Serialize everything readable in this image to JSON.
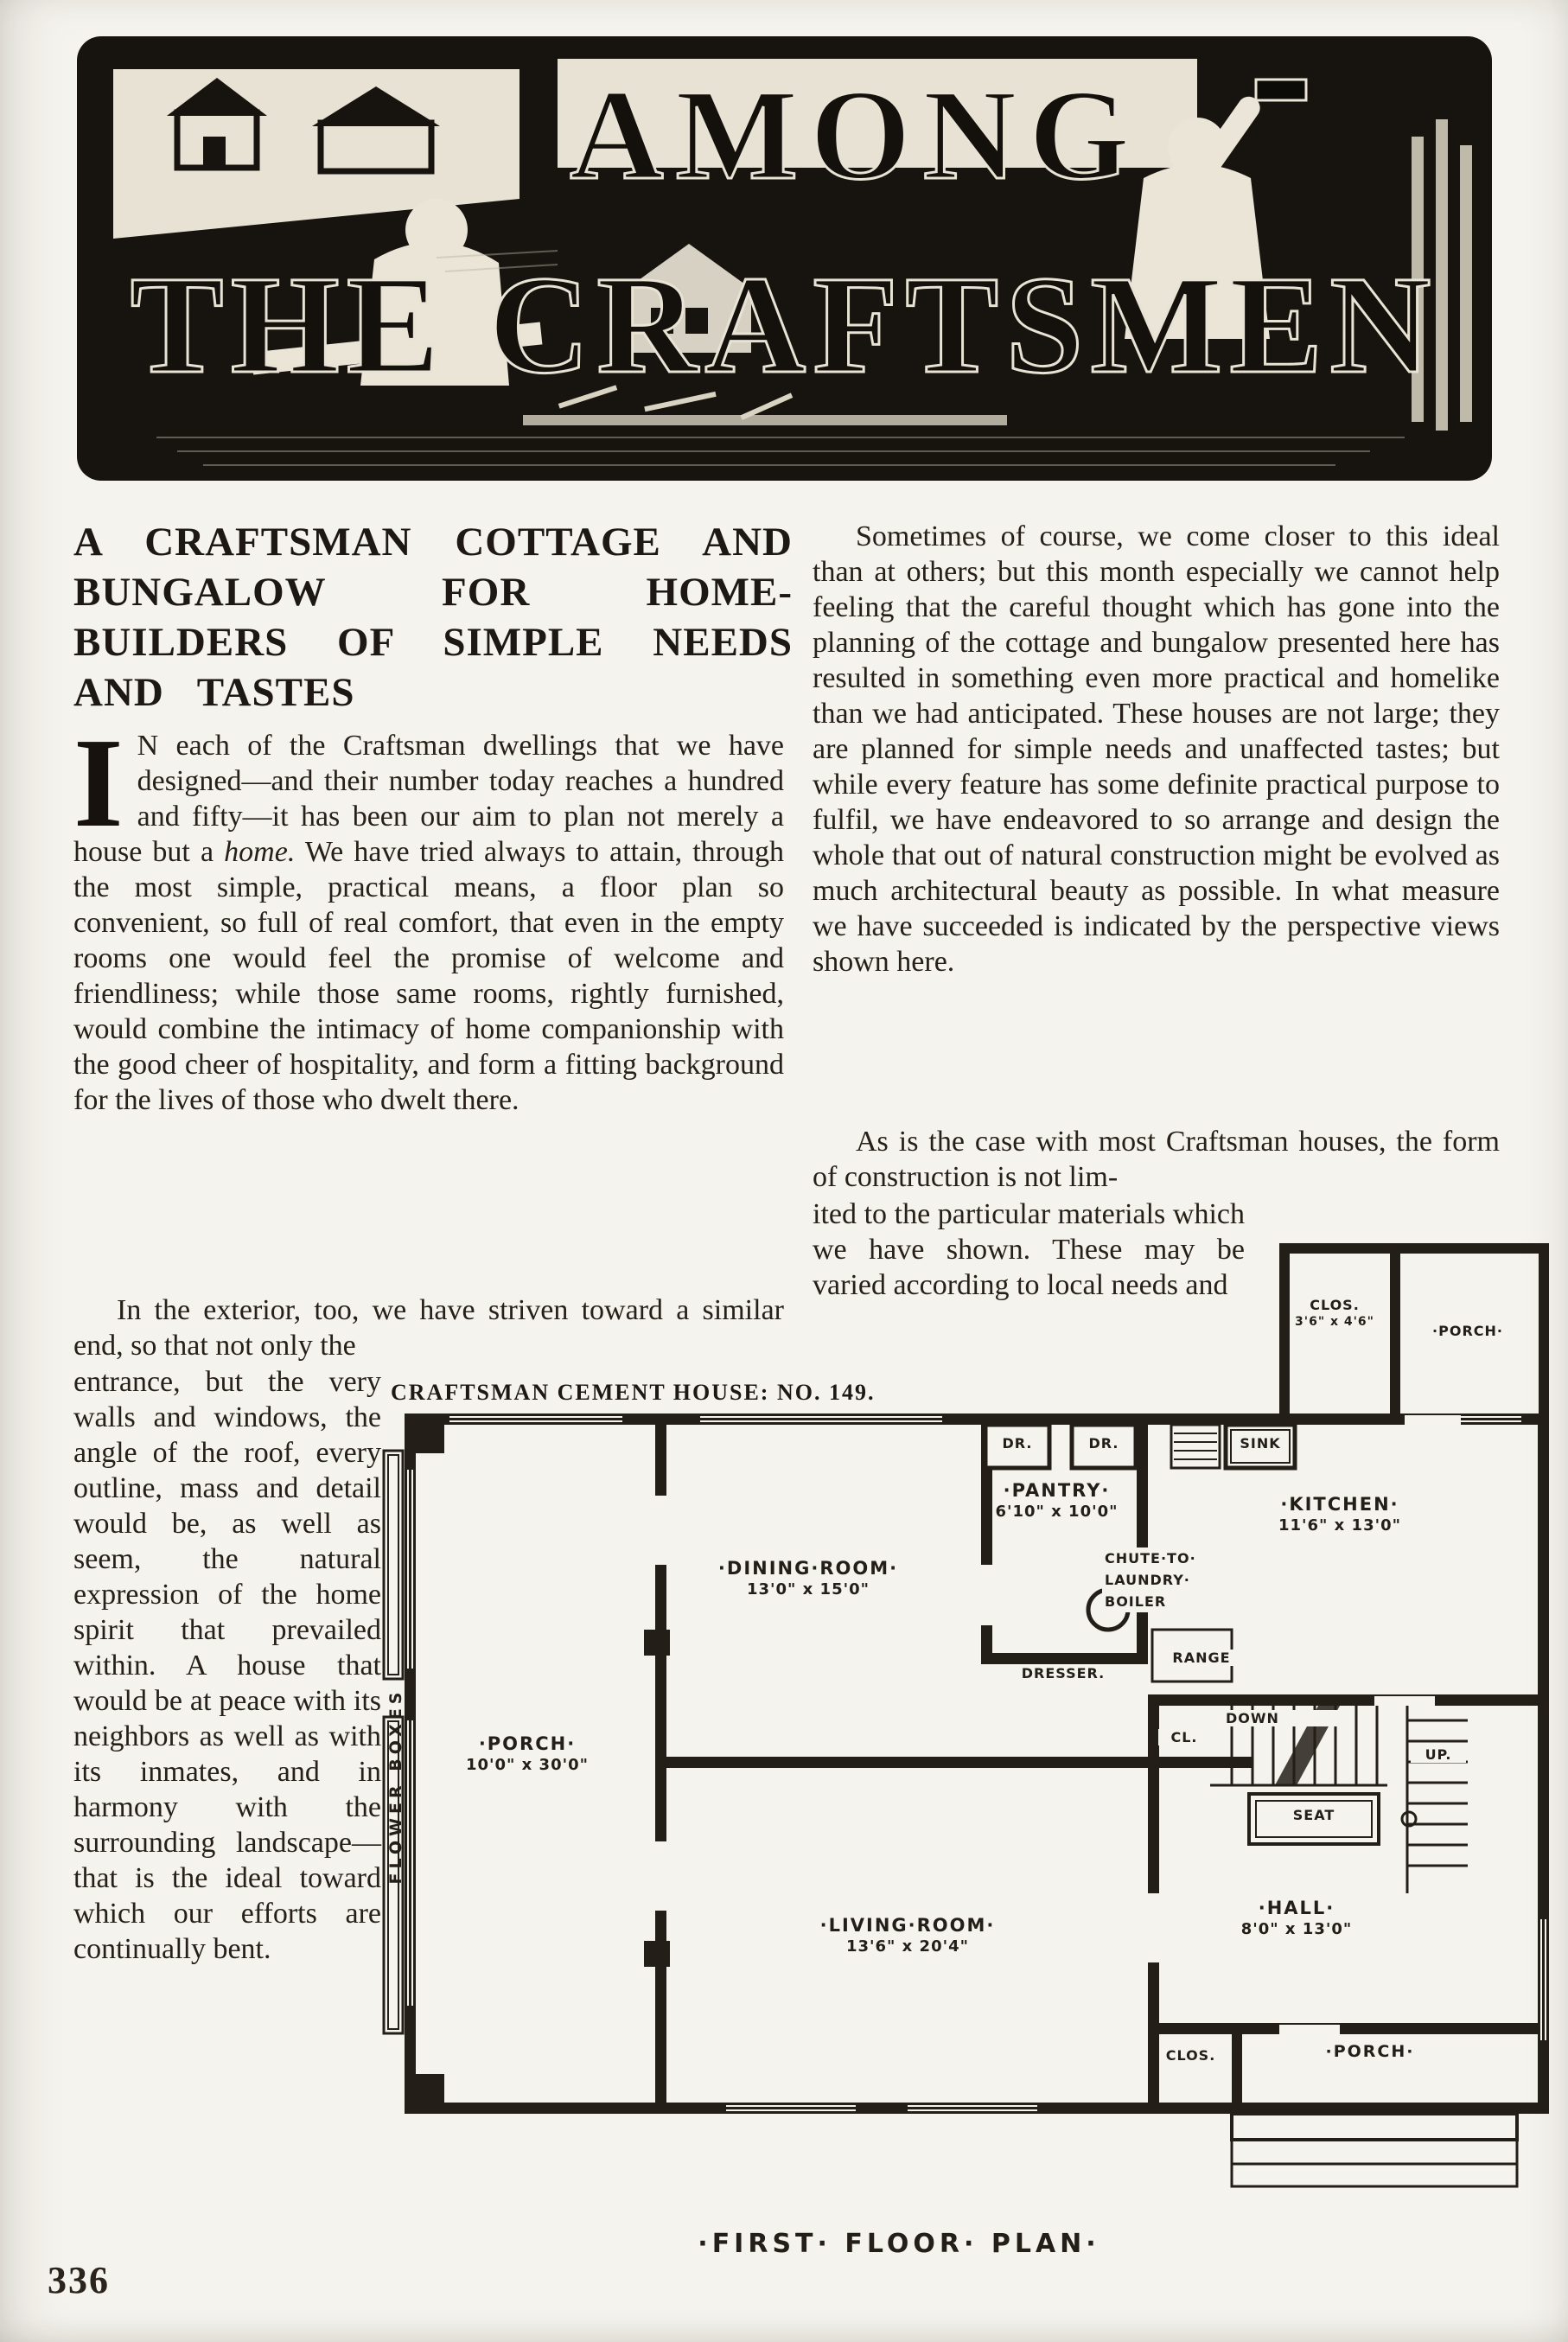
{
  "masthead": {
    "line1": "AMONG",
    "line2": "THE CRAFTSMEN"
  },
  "article": {
    "title": [
      "A CRAFTSMAN COTTAGE AND",
      "BUNGALOW FOR HOME-",
      "BUILDERS OF SIMPLE NEEDS",
      "AND TASTES"
    ],
    "left": {
      "dropcap": "I",
      "p1a": "N each of the Craftsman dwellings that we have designed—and their number today reaches a hundred and fifty—it has been our aim to plan not merely a house but a ",
      "p1_italic": "home.",
      "p1b": "  We have tried always to attain, through the most simple, practical means, a floor plan so convenient, so full of real comfort, that even in the empty rooms one would feel the promise of welcome and friendliness; while those same rooms, rightly furnished, would combine the intimacy of home companionship with the good cheer of hospitality, and form a fitting background for the lives of those who dwelt there.",
      "p2_wide": "In the exterior, too, we have striven toward a similar end, so that not only the",
      "p2_narrow": "entrance, but the very walls and windows, the angle of the roof, every outline, mass and detail would be, as well as seem, the natural expression of the home spirit that prevailed within.  A house that would be at peace with its neighbors as well as with its inmates, and in harmony with the surrounding landscape—that is the ideal toward which our efforts are continually bent."
    },
    "right": {
      "p1": "Sometimes of course, we come closer to this ideal than at others; but this month especially we cannot help feeling that the careful thought which has gone into the planning of the cottage and bungalow presented here has resulted in something even more practical and homelike than we had anticipated.  These houses are not large; they are planned for simple needs and unaffected tastes; but while every feature has some definite practical purpose to fulfil, we have endeavored to so arrange and design the whole that out of natural construction might be evolved as much architectural beauty as possible.  In what measure we have succeeded is indicated by the perspective views shown here.",
      "p2_wide": "As is the case with most Craftsman houses, the form of construction is not lim-",
      "p2_narrow": "ited to the particular materials which we have shown.  These may be varied according to local needs and"
    }
  },
  "floorplan": {
    "caption": "CRAFTSMAN CEMENT HOUSE: NO. 149.",
    "title": "·FIRST· FLOOR· PLAN·",
    "rooms": {
      "porch_left": {
        "name": "·PORCH·",
        "dims": "10'0\" x 30'0\""
      },
      "dining": {
        "name": "·DINING·ROOM·",
        "dims": "13'0\" x 15'0\""
      },
      "living": {
        "name": "·LIVING·ROOM·",
        "dims": "13'6\" x 20'4\""
      },
      "pantry": {
        "name": "·PANTRY·",
        "dims": "6'10\" x 10'0\""
      },
      "kitchen": {
        "name": "·KITCHEN·",
        "dims": "11'6\" x 13'0\""
      },
      "hall": {
        "name": "·HALL·",
        "dims": "8'0\" x 13'0\""
      },
      "clos_top": {
        "name": "CLOS.",
        "dims": "3'6\" x 4'6\""
      },
      "porch_top": {
        "name": "·PORCH·"
      },
      "clos_bottom": {
        "name": "CLOS."
      },
      "porch_bottom": {
        "name": "·PORCH·"
      }
    },
    "fixtures": {
      "chute1": "CHUTE·TO·",
      "chute2": "LAUNDRY·",
      "chute3": "BOILER",
      "dresser": "DRESSER.",
      "range": "RANGE",
      "dr1": "DR.",
      "dr2": "DR.",
      "sink": "SINK",
      "cl": "CL.",
      "down": "DOWN",
      "up": "UP.",
      "seat": "SEAT",
      "flower_boxes": "FLOWER BOXES"
    }
  },
  "page": {
    "number": "336"
  }
}
